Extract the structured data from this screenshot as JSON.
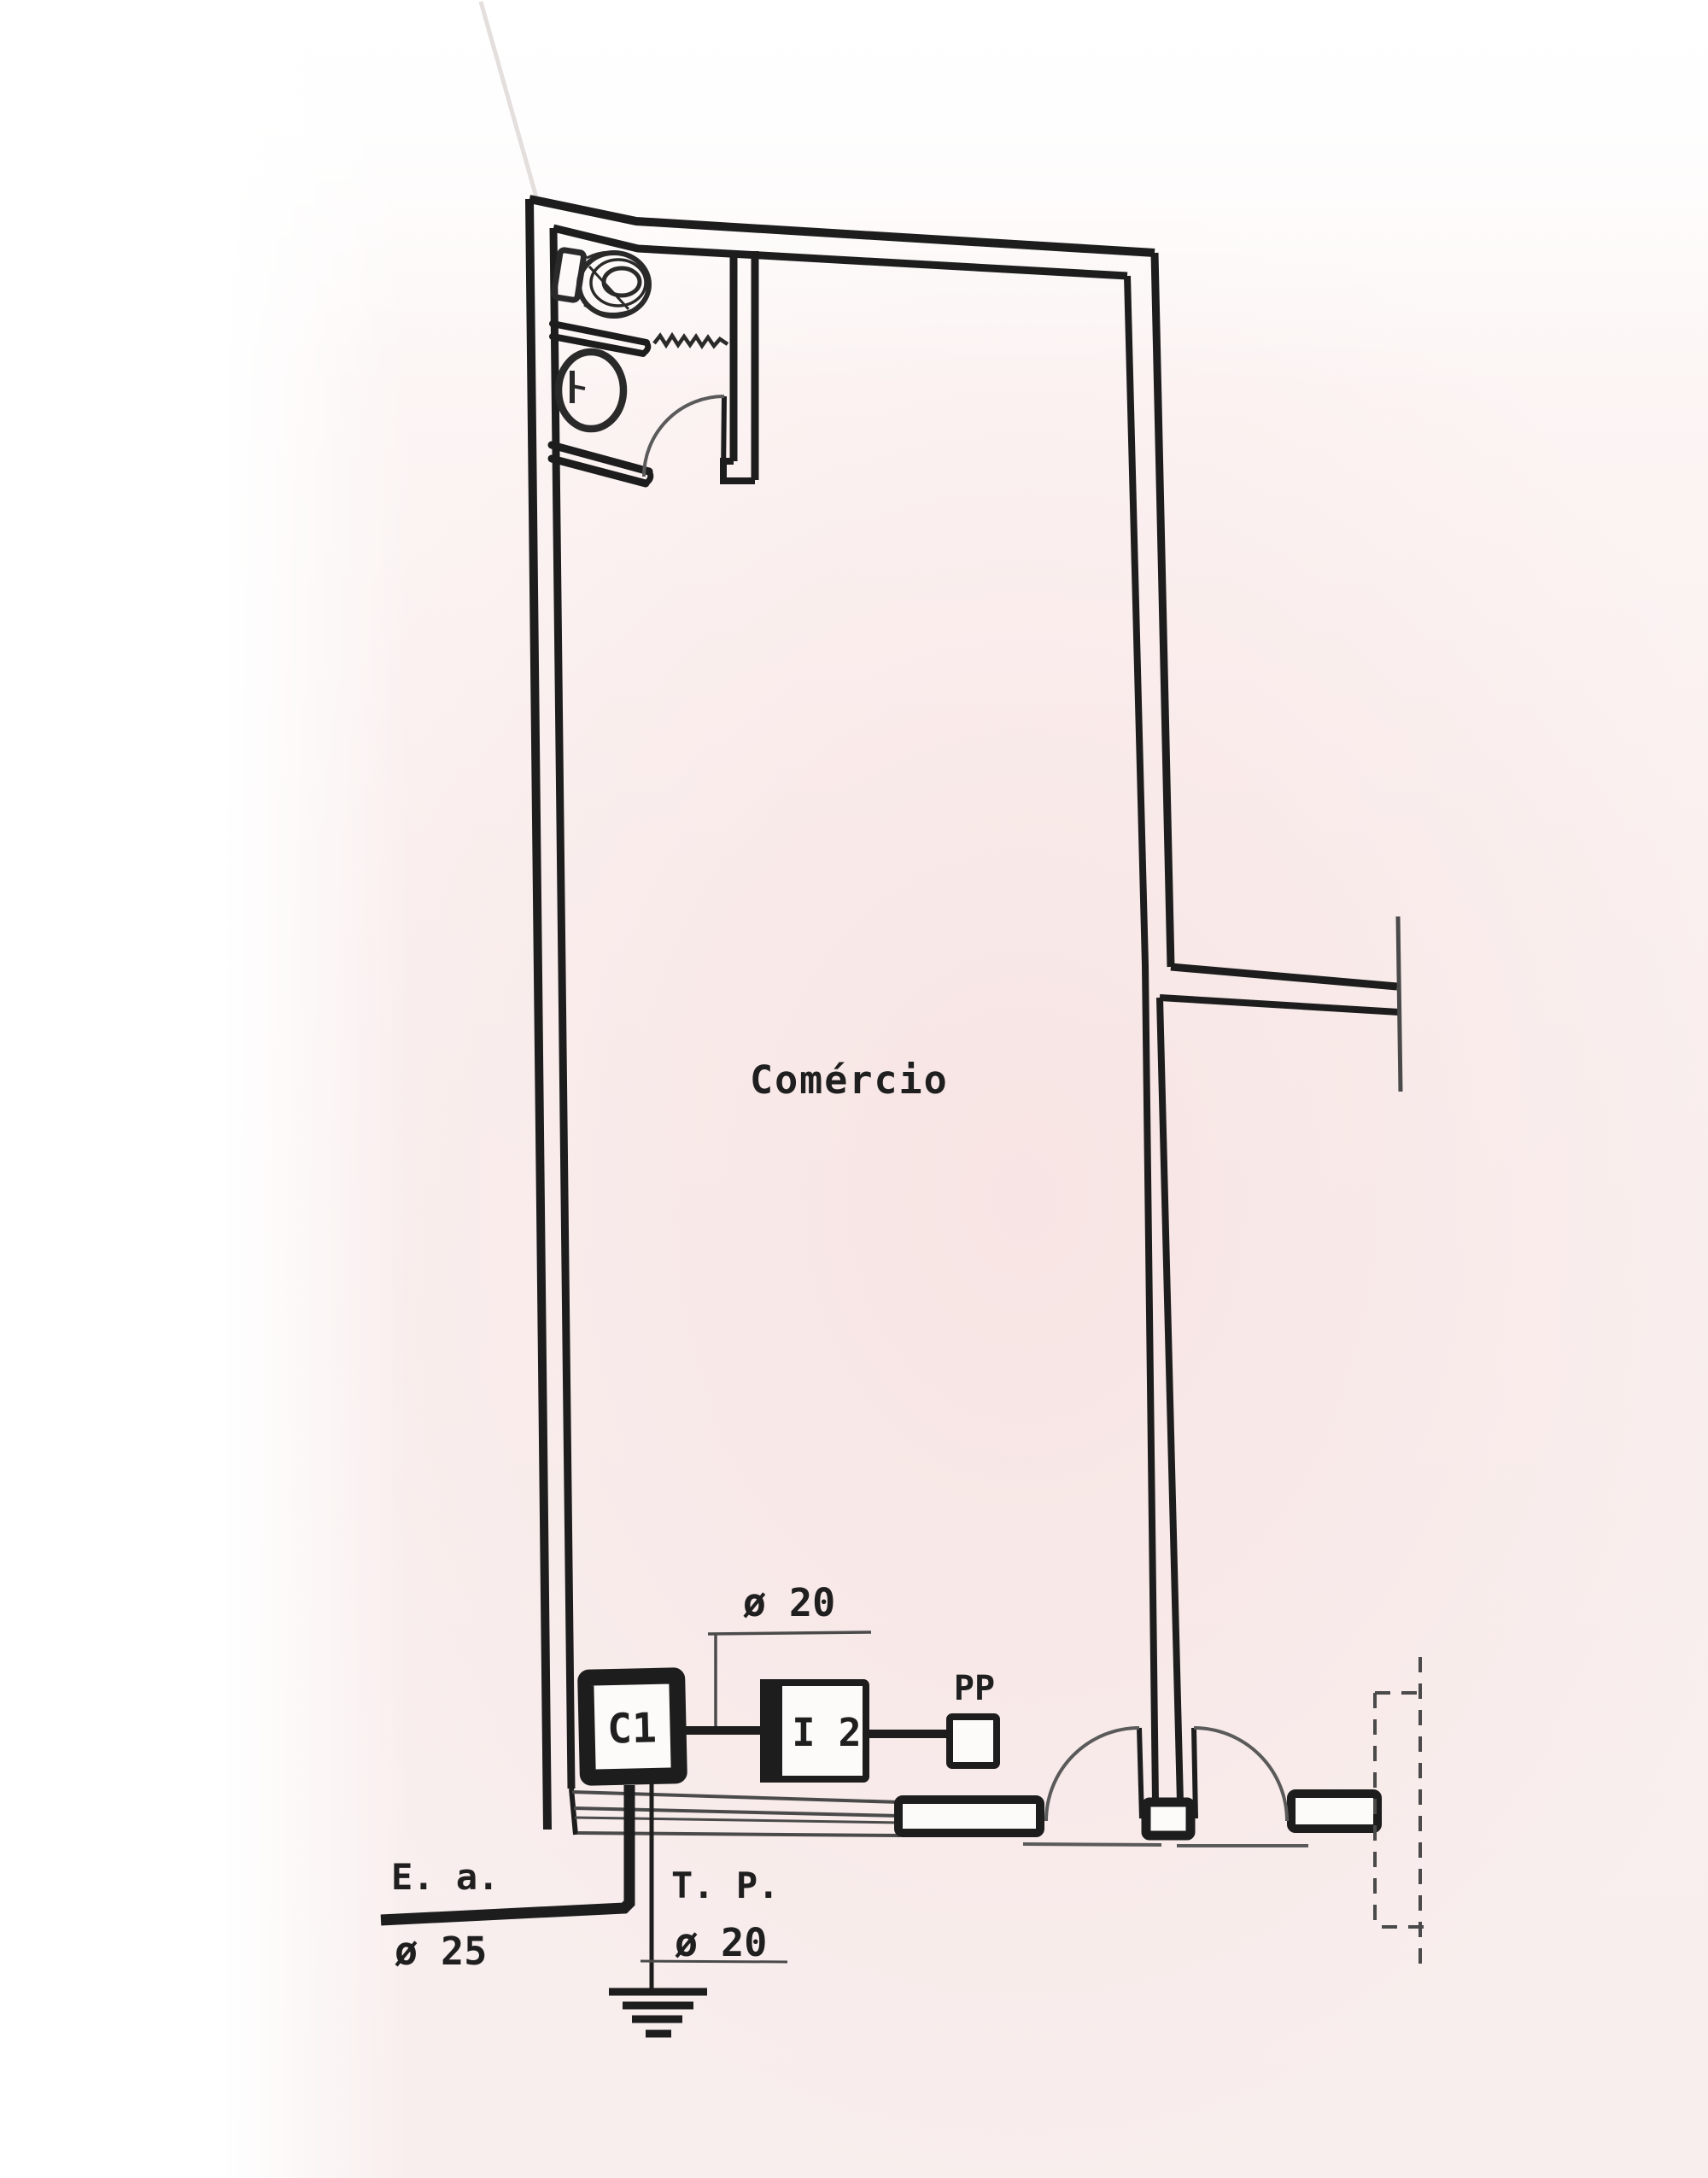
{
  "page": {
    "background": "#f8efee",
    "ink": "#1d1d1d"
  },
  "plan": {
    "room_label": "Comércio"
  },
  "electrical": {
    "panel_label": "C1",
    "meter_label": "I 2",
    "pp_label": "PP",
    "branch_conduit_dim": "ø 20",
    "service_entrance_label": "E. a.",
    "service_entrance_dim": "ø 25",
    "ground_wire_label": "T. P.",
    "ground_conduit_dim": "ø 20"
  }
}
